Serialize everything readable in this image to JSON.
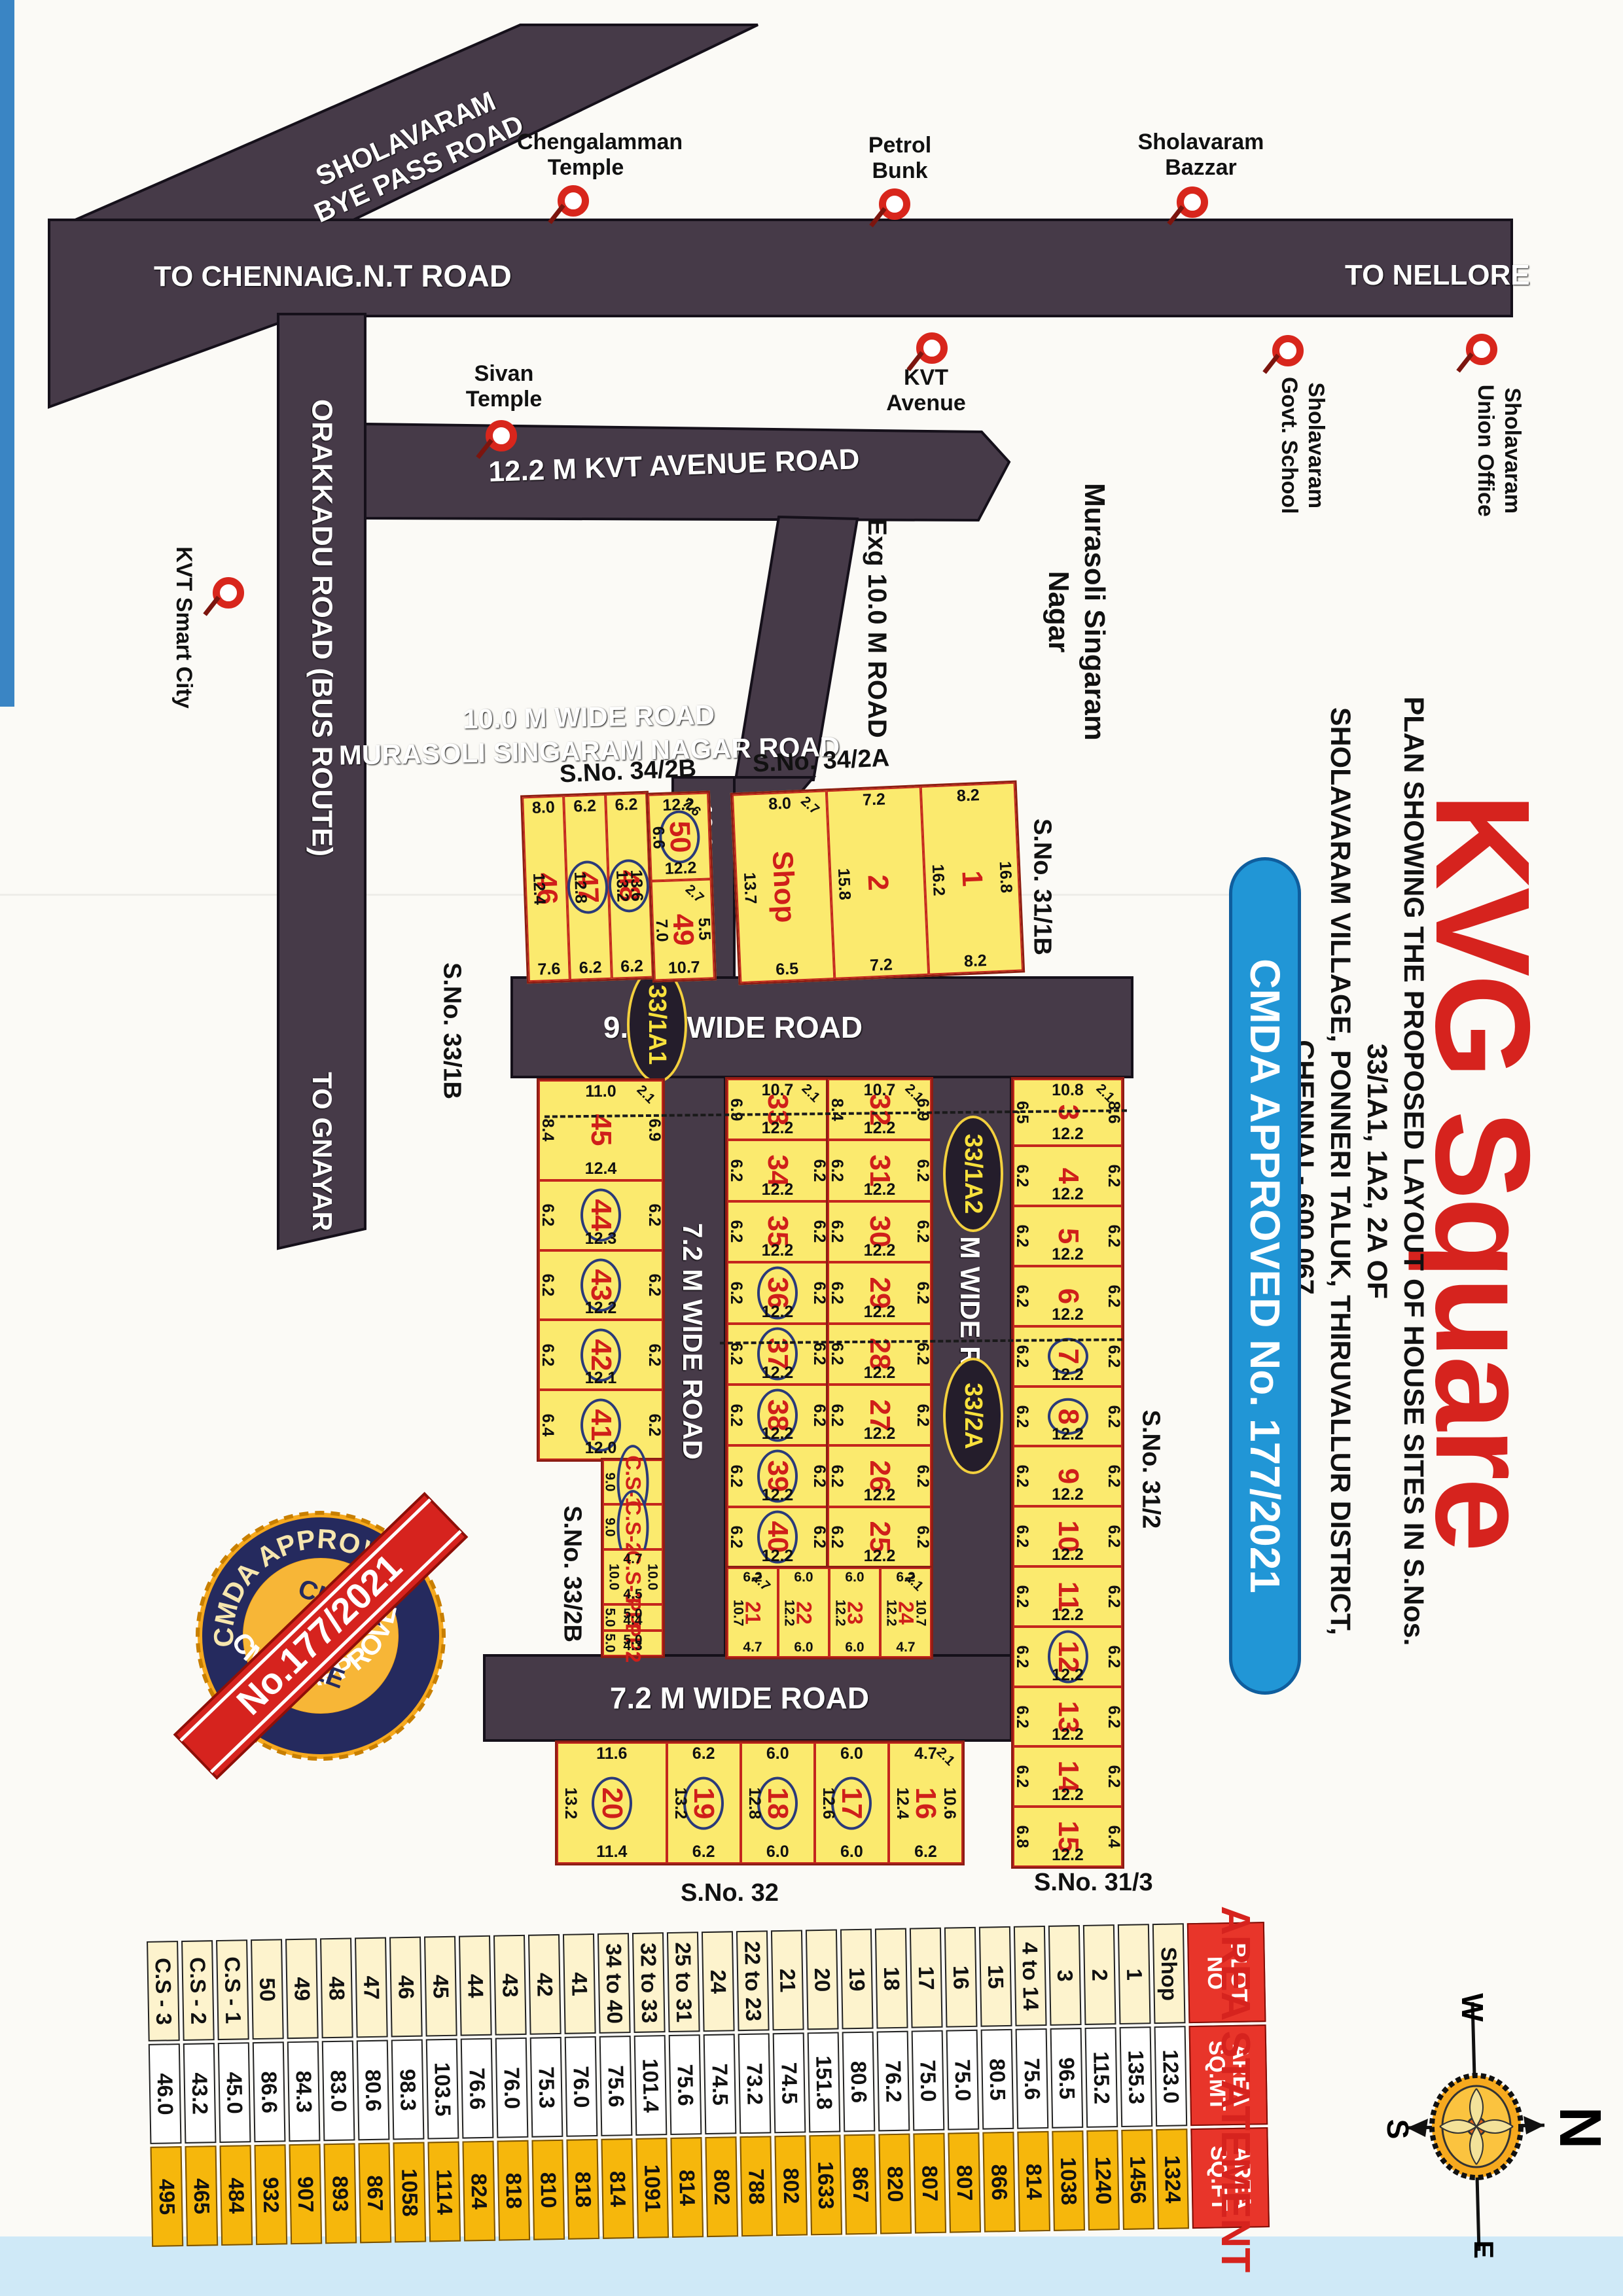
{
  "title": {
    "kvg": "KVG Square",
    "note1": "PLAN SHOWING THE PROPOSED LAYOUT OF HOUSE SITES IN S.Nos. 33/1A1, 1A2, 2A OF",
    "note2": "SHOLAVARAM VILLAGE, PONNERI TALUK, THIRUVALLUR DISTRICT, CHENNAI - 600 067.",
    "pill": "CMDA APPROVED No. 177/2021"
  },
  "roads": {
    "gnt": "G.N.T ROAD",
    "to_chennai": "TO CHENNAI",
    "to_nellore": "TO NELLORE",
    "byepass1": "SHOLAVARAM",
    "byepass2": "BYE PASS ROAD",
    "orakkadu": "ORAKKADU ROAD (BUS ROUTE)",
    "to_gnayar": "TO GNAYAR",
    "kvt_ave": "12.2 M KVT AVENUE ROAD",
    "msn1": "10.0 M WIDE ROAD",
    "msn2": "MURASOLI SINGARAM NAGAR ROAD",
    "exg": "Exg 10.0 M ROAD",
    "r10": "10.0 M ROAD",
    "r9h": "9.0 M WIDE ROAD",
    "r9v": "9.0 M WIDE ROAD",
    "r72v": "7.2 M WIDE ROAD",
    "r72h": "7.2 M WIDE ROAD"
  },
  "landmarks": {
    "chengalamman": {
      "l1": "Chengalamman",
      "l2": "Temple"
    },
    "petrol": {
      "l1": "Petrol",
      "l2": "Bunk"
    },
    "bazzar": {
      "l1": "Sholavaram",
      "l2": "Bazzar"
    },
    "sivan": {
      "l1": "Sivan",
      "l2": "Temple"
    },
    "kvt_avenue": {
      "l1": "KVT",
      "l2": "Avenue"
    },
    "school": {
      "l1": "Sholavaram",
      "l2": "Govt. School"
    },
    "union_office": {
      "l1": "Sholavaram",
      "l2": "Union Office"
    },
    "smart_city": {
      "l1": "KVT Smart City"
    },
    "murasoli1": "Murasoli Singaram",
    "murasoli2": "Nagar"
  },
  "sno": {
    "s342b": "S.No. 34/2B",
    "s342a": "S.No. 34/2A",
    "s311b": "S.No. 31/1B",
    "s331b": "S.No. 33/1B",
    "s312": "S.No. 31/2",
    "s332b": "S.No. 33/2B",
    "s32": "S.No. 32",
    "s313": "S.No. 31/3"
  },
  "badges": {
    "b1": "33/1A1",
    "b2": "33/1A2",
    "b3": "33/2A"
  },
  "seal": {
    "ring_top": "CMDA APPROVED",
    "ring_bottom": "CMDA APPROVED",
    "c1": "CLEAR",
    "c2": "TITLE",
    "ribbon": "No.177/2021"
  },
  "compass": {
    "n": "N",
    "s": "S",
    "e": "E",
    "w": "W"
  },
  "blocks": {
    "A_cols": [
      {
        "n": "46",
        "t": "8.0",
        "l": "12.4",
        "b": "7.6"
      },
      {
        "n": "47",
        "c": 1,
        "t": "6.2",
        "l": "12.8",
        "b": "6.2"
      },
      {
        "n": "48",
        "c": 1,
        "t": "6.2",
        "l": "13.2",
        "r": "13.6",
        "b": "6.2"
      }
    ],
    "A_stack": [
      {
        "n": "50",
        "c": 1,
        "t": "12.2",
        "l": "6.6",
        "b": "12.2",
        "d": "7.6"
      },
      {
        "n": "49",
        "l": "7.0",
        "r": "5.5",
        "b": "10.7",
        "d": "2.7"
      }
    ],
    "B": [
      {
        "n": "Shop",
        "t": "8.0",
        "l": "13.7",
        "b": "6.5",
        "d": "2.7"
      },
      {
        "n": "2",
        "t": "7.2",
        "l": "15.8",
        "b": "7.2"
      },
      {
        "n": "1",
        "t": "8.2",
        "l": "16.2",
        "r": "16.8",
        "b": "8.2"
      }
    ],
    "C": [
      {
        "n": "45",
        "t": "11.0",
        "l": "8.4",
        "r": "6.9",
        "b": "12.4",
        "d": "2.1"
      },
      {
        "n": "44",
        "c": 1,
        "l": "6.2",
        "r": "6.2",
        "b": "12.3"
      },
      {
        "n": "43",
        "c": 1,
        "l": "6.2",
        "r": "6.2",
        "b": "12.2"
      },
      {
        "n": "42",
        "c": 1,
        "l": "6.2",
        "r": "6.2",
        "b": "12.1"
      },
      {
        "n": "41",
        "c": 1,
        "l": "6.4",
        "r": "6.2",
        "b": "12.0"
      }
    ],
    "C2": [
      {
        "n": "C.S-1",
        "c": 1,
        "l": "9.0"
      },
      {
        "n": "C.S-2",
        "c": 1,
        "l": "9.0"
      },
      {
        "n": "C.S-3",
        "t": "4.7",
        "l": "10.0",
        "r": "10.0",
        "b": "4.5"
      },
      {
        "n": "PP1",
        "t": "5.0",
        "l": "5.0",
        "b": "4.4"
      },
      {
        "n": "PP2",
        "t": "5.0",
        "l": "5.0",
        "b": "4.3"
      }
    ],
    "D": [
      {
        "n": "33",
        "t": "10.7",
        "l": "6.9",
        "b": "12.2",
        "d": "2.1"
      },
      {
        "n": "34",
        "l": "6.2",
        "r": "6.2",
        "b": "12.2"
      },
      {
        "n": "35",
        "l": "6.2",
        "r": "6.2",
        "b": "12.2"
      },
      {
        "n": "36",
        "c": 1,
        "l": "6.2",
        "r": "6.2",
        "b": "12.2"
      },
      {
        "n": "37",
        "c": 1,
        "l": "6.2",
        "r": "6.2",
        "b": "12.2"
      },
      {
        "n": "38",
        "c": 1,
        "l": "6.2",
        "r": "6.2",
        "b": "12.2"
      },
      {
        "n": "39",
        "c": 1,
        "l": "6.2",
        "r": "6.2",
        "b": "12.2"
      },
      {
        "n": "40",
        "c": 1,
        "l": "6.2",
        "r": "6.2",
        "b": "12.2"
      }
    ],
    "E": [
      {
        "n": "32",
        "t": "10.7",
        "l": "8.4",
        "r": "6.9",
        "b": "12.2",
        "d": "2.1"
      },
      {
        "n": "31",
        "l": "6.2",
        "r": "6.2",
        "b": "12.2"
      },
      {
        "n": "30",
        "l": "6.2",
        "r": "6.2",
        "b": "12.2"
      },
      {
        "n": "29",
        "l": "6.2",
        "r": "6.2",
        "b": "12.2"
      },
      {
        "n": "28",
        "l": "6.2",
        "r": "6.2",
        "b": "12.2"
      },
      {
        "n": "27",
        "l": "6.2",
        "r": "6.2",
        "b": "12.2"
      },
      {
        "n": "26",
        "l": "6.2",
        "r": "6.2",
        "b": "12.2"
      },
      {
        "n": "25",
        "l": "6.2",
        "r": "6.2",
        "b": "12.2"
      }
    ],
    "F": [
      {
        "n": "21",
        "t": "6.2",
        "l": "10.7",
        "b": "4.7",
        "d": "2.7"
      },
      {
        "n": "22",
        "t": "6.0",
        "l": "12.2",
        "b": "6.0"
      },
      {
        "n": "23",
        "t": "6.0",
        "l": "12.2",
        "b": "6.0"
      },
      {
        "n": "24",
        "t": "6.2",
        "l": "12.2",
        "r": "10.7",
        "b": "4.7",
        "d": "2.1"
      }
    ],
    "G": [
      {
        "n": "3",
        "t": "10.8",
        "l": "6.5",
        "r": "8.6",
        "b": "12.2",
        "d": "2.1"
      },
      {
        "n": "4",
        "l": "6.2",
        "r": "6.2",
        "b": "12.2"
      },
      {
        "n": "5",
        "l": "6.2",
        "r": "6.2",
        "b": "12.2"
      },
      {
        "n": "6",
        "l": "6.2",
        "r": "6.2",
        "b": "12.2"
      },
      {
        "n": "7",
        "c": 1,
        "l": "6.2",
        "r": "6.2",
        "b": "12.2"
      },
      {
        "n": "8",
        "c": 1,
        "l": "6.2",
        "r": "6.2",
        "b": "12.2"
      },
      {
        "n": "9",
        "l": "6.2",
        "r": "6.2",
        "b": "12.2"
      },
      {
        "n": "10",
        "l": "6.2",
        "r": "6.2",
        "b": "12.2"
      },
      {
        "n": "11",
        "l": "6.2",
        "r": "6.2",
        "b": "12.2"
      },
      {
        "n": "12",
        "c": 1,
        "l": "6.2",
        "r": "6.2",
        "b": "12.2"
      },
      {
        "n": "13",
        "l": "6.2",
        "r": "6.2",
        "b": "12.2"
      },
      {
        "n": "14",
        "l": "6.2",
        "r": "6.2",
        "b": "12.2"
      },
      {
        "n": "15",
        "l": "6.8",
        "r": "6.4",
        "b": "12.2"
      }
    ],
    "H": [
      {
        "n": "20",
        "c": 1,
        "t": "11.6",
        "l": "13.2",
        "b": "11.4"
      },
      {
        "n": "19",
        "c": 1,
        "t": "6.2",
        "l": "13.2",
        "b": "6.2"
      },
      {
        "n": "18",
        "c": 1,
        "t": "6.0",
        "l": "12.8",
        "b": "6.0"
      },
      {
        "n": "17",
        "c": 1,
        "t": "6.0",
        "l": "12.6",
        "b": "6.0"
      },
      {
        "n": "16",
        "t": "4.7",
        "l": "12.4",
        "r": "10.6",
        "b": "6.2",
        "d": "2.1"
      }
    ]
  },
  "area": {
    "title": "AREA STATEMENT",
    "headers": [
      {
        "l1": "PLOT",
        "l2": "NO"
      },
      {
        "l1": "AREA",
        "l2": "SQ.MT"
      },
      {
        "l1": "AREA",
        "l2": "SQ.FT"
      }
    ],
    "rows": [
      [
        "Shop",
        "123.0",
        "1324"
      ],
      [
        "1",
        "135.3",
        "1456"
      ],
      [
        "2",
        "115.2",
        "1240"
      ],
      [
        "3",
        "96.5",
        "1038"
      ],
      [
        "4 to 14",
        "75.6",
        "814"
      ],
      [
        "15",
        "80.5",
        "866"
      ],
      [
        "16",
        "75.0",
        "807"
      ],
      [
        "17",
        "75.0",
        "807"
      ],
      [
        "18",
        "76.2",
        "820"
      ],
      [
        "19",
        "80.6",
        "867"
      ],
      [
        "20",
        "151.8",
        "1633"
      ],
      [
        "21",
        "74.5",
        "802"
      ],
      [
        "22 to 23",
        "73.2",
        "788"
      ],
      [
        "24",
        "74.5",
        "802"
      ],
      [
        "25 to 31",
        "75.6",
        "814"
      ],
      [
        "32 to 33",
        "101.4",
        "1091"
      ],
      [
        "34 to 40",
        "75.6",
        "814"
      ],
      [
        "41",
        "76.0",
        "818"
      ],
      [
        "42",
        "75.3",
        "810"
      ],
      [
        "43",
        "76.0",
        "818"
      ],
      [
        "44",
        "76.6",
        "824"
      ],
      [
        "45",
        "103.5",
        "1114"
      ],
      [
        "46",
        "98.3",
        "1058"
      ],
      [
        "47",
        "80.6",
        "867"
      ],
      [
        "48",
        "83.0",
        "893"
      ],
      [
        "49",
        "84.3",
        "907"
      ],
      [
        "50",
        "86.6",
        "932"
      ],
      [
        "C.S - 1",
        "45.0",
        "484"
      ],
      [
        "C.S - 2",
        "43.2",
        "465"
      ],
      [
        "C.S - 3",
        "46.0",
        "495"
      ]
    ]
  }
}
